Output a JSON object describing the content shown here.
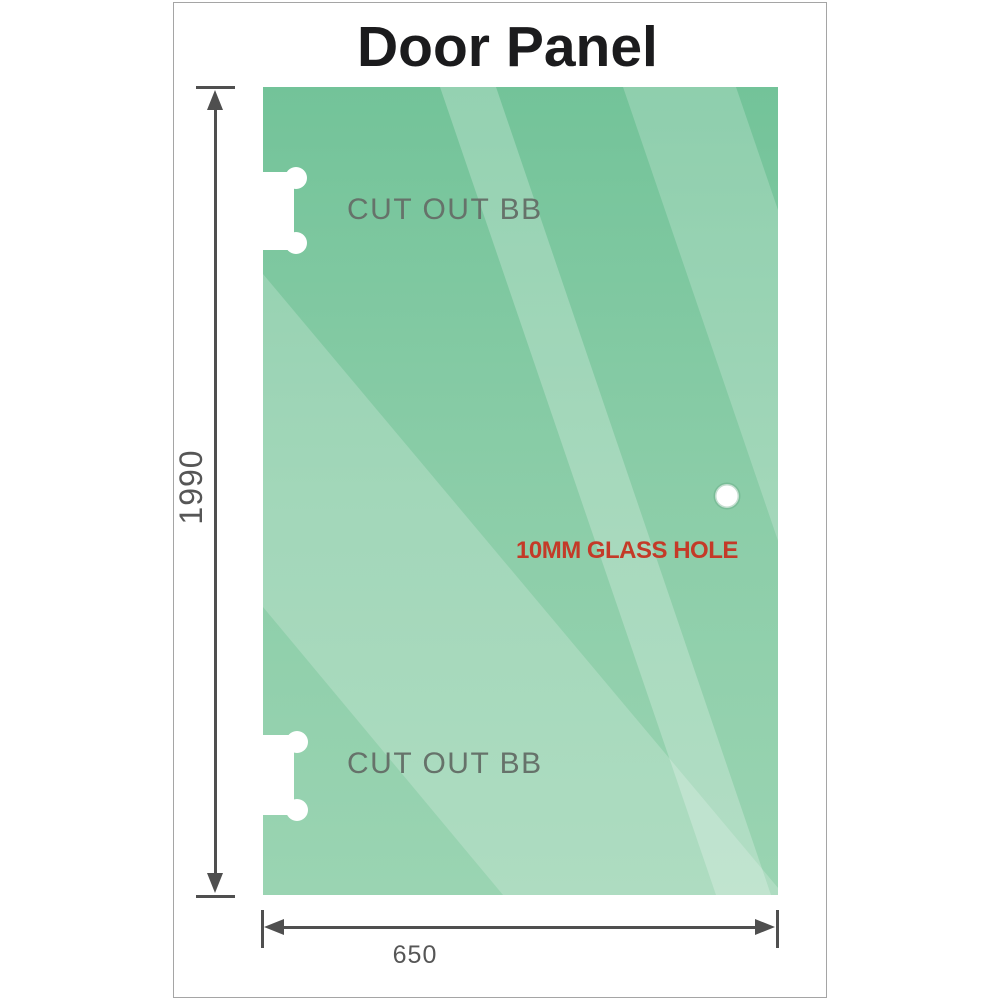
{
  "title": "Door Panel",
  "panel": {
    "name": "glass door panel",
    "dimensions": {
      "height": {
        "value": "1990"
      },
      "width": {
        "value": "650"
      }
    },
    "annotations": {
      "cutout_top": "CUT OUT BB",
      "cutout_bottom": "CUT OUT BB",
      "glass_hole": "10MM GLASS HOLE"
    }
  },
  "colors": {
    "glass_green_top": "#73c399",
    "glass_green_mid": "#8bcda8",
    "glass_green_bottom": "#9ad4b2",
    "glass_highlight": "#ffffff",
    "dimension_line": "#4f4f4f",
    "dimension_text": "#565656",
    "cutout_text": "#66726a",
    "glass_hole_text": "#c43a28",
    "title_text": "#1b1b1d",
    "frame_border": "#a5a5a5"
  }
}
